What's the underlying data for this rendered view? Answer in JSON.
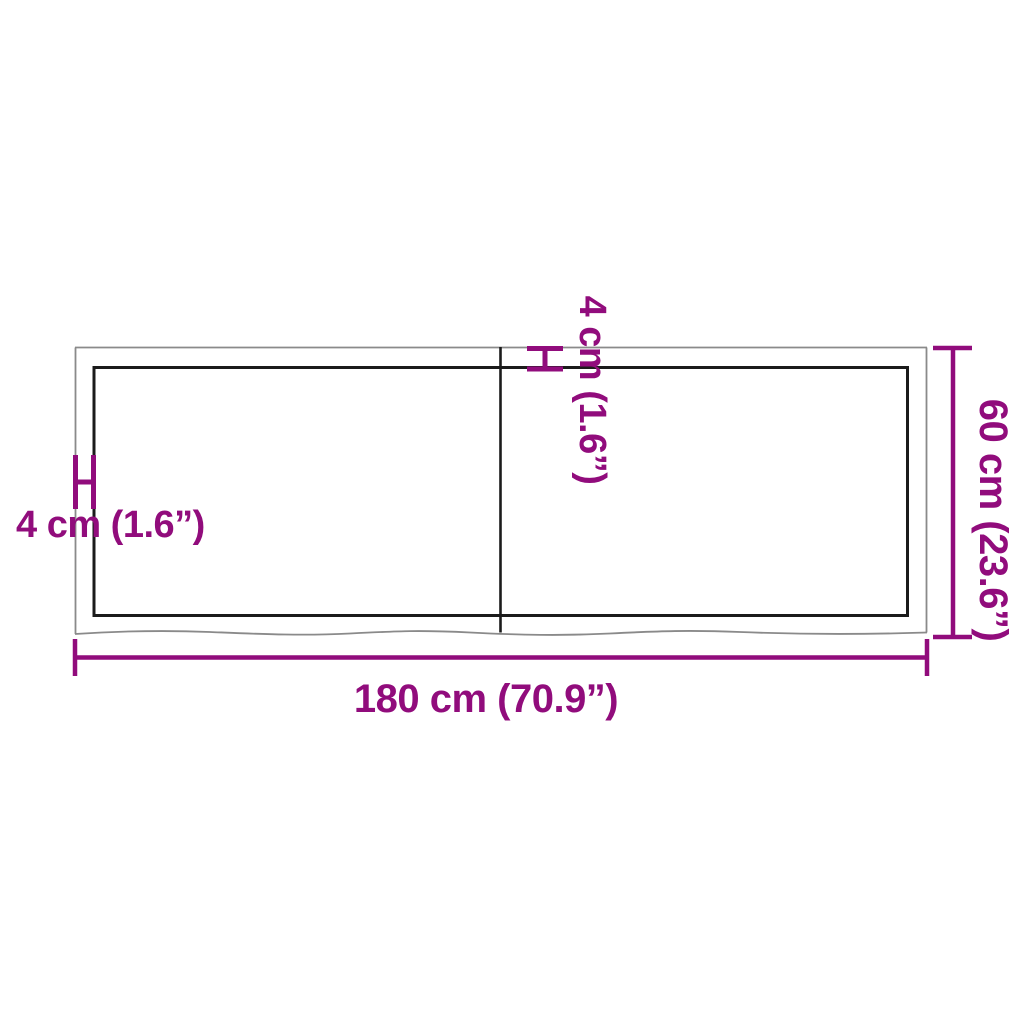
{
  "diagram": {
    "title": "tabletop-dimension-diagram",
    "labels": {
      "width": "180 cm (70.9”)",
      "depth": "60 cm (23.6”)",
      "thickness_side": "4 cm (1.6”)",
      "thickness_top": "4 cm (1.6”)"
    },
    "colors": {
      "dimension_accent": "#910C7C",
      "outer_outline": "#8A8A8A",
      "inner_outline": "#1B1B1B",
      "background": "#FFFFFF"
    }
  }
}
